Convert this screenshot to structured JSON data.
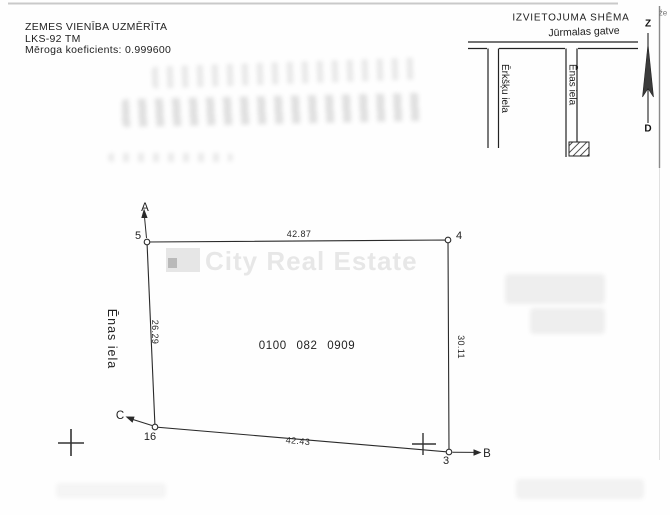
{
  "header": {
    "line1": "ZEMES VIENĪBA UZMĒRĪTA",
    "line2": "LKS-92 TM",
    "line3": "Mēroga koeficients: 0.999600"
  },
  "schema": {
    "title": "IZVIETOJUMA SHĒMA",
    "street_top": "Jūrmalas gatve",
    "street_left": "Ērkšķu iela",
    "street_right": "Ēnas iela",
    "compass_north": "Z",
    "compass_south": "D",
    "edge_note": "že"
  },
  "parcel": {
    "cadastre_number": "0100 082 0909",
    "street_label": "Ēnas iela",
    "points": {
      "p5": "5",
      "p4": "4",
      "p3": "3",
      "p16": "16"
    },
    "directions": {
      "a": "A",
      "b": "B",
      "c": "C"
    },
    "dimensions": {
      "top": "42.87",
      "left": "26.29",
      "right": "30.11",
      "bottom": "42.43"
    }
  },
  "watermark": {
    "text": "City Real Estate"
  },
  "colors": {
    "ink": "#1f1f1f",
    "border": "#8a8a8a",
    "watermark_gray": "#e6e6e6"
  }
}
